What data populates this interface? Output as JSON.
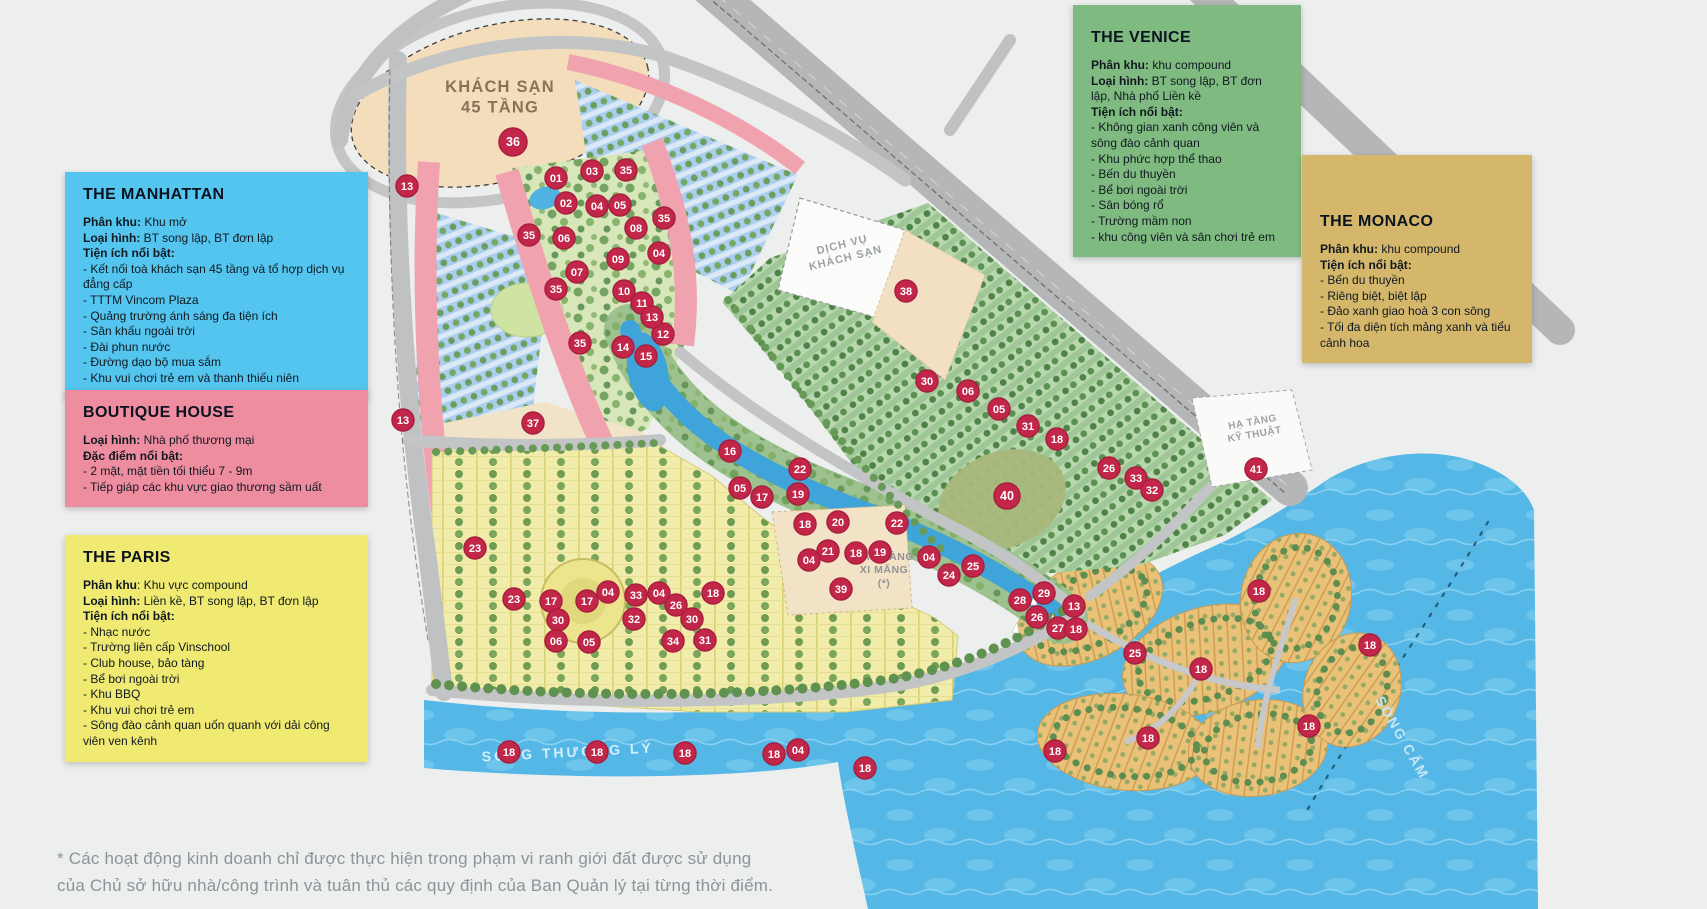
{
  "legends": {
    "manhattan": {
      "title": "THE MANHATTAN",
      "color": "#54c5ee",
      "lines": [
        {
          "b": "Phân khu:",
          "t": " Khu mở"
        },
        {
          "b": "Loại hình:",
          "t": " BT song lập, BT đơn lập"
        },
        {
          "b": "Tiện ích nổi bật:",
          "t": ""
        },
        {
          "b": "",
          "t": "-  Kết nối toà khách sạn 45 tầng và tổ hợp dịch vụ đẳng cấp"
        },
        {
          "b": "",
          "t": "-  TTTM Vincom Plaza"
        },
        {
          "b": "",
          "t": "-  Quảng trường ánh sáng đa tiện ích"
        },
        {
          "b": "",
          "t": "-  Sân khấu ngoài trời"
        },
        {
          "b": "",
          "t": "-  Đài phun nước"
        },
        {
          "b": "",
          "t": "-  Đường dạo bộ mua sắm"
        },
        {
          "b": "",
          "t": "-  Khu vui chơi trẻ em và thanh thiếu niên"
        }
      ]
    },
    "boutique": {
      "title": "BOUTIQUE HOUSE",
      "color": "#ef8da0",
      "lines": [
        {
          "b": "Loại hình:",
          "t": " Nhà phố thương mại"
        },
        {
          "b": "Đặc điểm nổi bật:",
          "t": ""
        },
        {
          "b": "",
          "t": "-  2 mặt, mặt tiền tối thiểu 7 - 9m"
        },
        {
          "b": "",
          "t": "-  Tiếp giáp các khu vực giao thương sầm uất"
        }
      ]
    },
    "paris": {
      "title": "THE PARIS",
      "color": "#f0ea72",
      "lines": [
        {
          "b": "Phân khu",
          "t": ": Khu vực compound"
        },
        {
          "b": "Loại hình:",
          "t": " Liền kề, BT song lập, BT đơn lập"
        },
        {
          "b": "Tiện ích nổi bật:",
          "t": ""
        },
        {
          "b": "",
          "t": "-  Nhạc nước"
        },
        {
          "b": "",
          "t": "-  Trường liên cấp Vinschool"
        },
        {
          "b": "",
          "t": "-  Club house, bảo tàng"
        },
        {
          "b": "",
          "t": "-  Bể bơi ngoài trời"
        },
        {
          "b": "",
          "t": "-  Khu BBQ"
        },
        {
          "b": "",
          "t": "-  Khu vui chơi trẻ em"
        },
        {
          "b": "",
          "t": "-  Sông đào cảnh quan uốn quanh với dải công viên ven kênh"
        }
      ]
    },
    "venice": {
      "title": "THE VENICE",
      "color": "#7fba80",
      "lines": [
        {
          "b": "Phân khu:",
          "t": " khu compound"
        },
        {
          "b": "Loại hình:",
          "t": " BT song lập, BT đơn lập, Nhà phố Liền kề"
        },
        {
          "b": "Tiện ích nổi bật:",
          "t": ""
        },
        {
          "b": "",
          "t": "-  Không gian xanh công viên và sông đào cảnh quan"
        },
        {
          "b": "",
          "t": "-  Khu phức hợp thể thao"
        },
        {
          "b": "",
          "t": "-  Bến du thuyền"
        },
        {
          "b": "",
          "t": "-  Bể bơi ngoài trời"
        },
        {
          "b": "",
          "t": "-  Sân bóng rổ"
        },
        {
          "b": "",
          "t": "-  Trường mầm non"
        },
        {
          "b": "",
          "t": "-  khu công viên và sân chơi trẻ em"
        }
      ]
    },
    "monaco": {
      "title": "THE MONACO",
      "color": "#d4b76b",
      "lines": [
        {
          "b": "Phân khu:",
          "t": " khu compound"
        },
        {
          "b": "Tiện ích nổi bật:",
          "t": ""
        },
        {
          "b": "",
          "t": "-  Bến du thuyền"
        },
        {
          "b": "",
          "t": "-  Riêng biệt, biệt lập"
        },
        {
          "b": "",
          "t": "-  Đảo xanh giao hoà 3 con sông"
        },
        {
          "b": "",
          "t": "-  Tối đa diện tích mảng xanh và tiểu cảnh hoa"
        }
      ]
    }
  },
  "footnote": {
    "line1": "* Các hoạt động kinh doanh chỉ được thực hiện trong phạm vi ranh giới đất được sử dụng",
    "line2": "của Chủ sở hữu nhà/công trình và tuân thủ các quy định của Ban Quản lý tại từng thời điểm."
  },
  "map": {
    "marker_color": "#c2274a",
    "marker_ring_color": "#a81e3e",
    "marker_text_color": "#ffffff",
    "labels": [
      {
        "lines": [
          "KHÁCH SẠN",
          "45 TẦNG"
        ],
        "x": 500,
        "y": 92,
        "size": 16.5,
        "color": "#8b7157",
        "rotate": 0,
        "spacing": 1.2
      },
      {
        "lines": [
          "DỊCH VỤ",
          "KHÁCH SẠN"
        ],
        "x": 843,
        "y": 248,
        "size": 11,
        "color": "#9ba1a5",
        "rotate": -14,
        "spacing": 1
      },
      {
        "lines": [
          "HẠ TẦNG",
          "KỸ THUẬT"
        ],
        "x": 1253,
        "y": 425,
        "size": 10,
        "color": "#9ba1a5",
        "rotate": -10,
        "spacing": 0.5
      },
      {
        "lines": [
          "BẢO TÀNG",
          "XI MĂNG",
          "(*)"
        ],
        "x": 884,
        "y": 560,
        "size": 10.5,
        "color": "#8f9296",
        "rotate": 0,
        "spacing": 0.5
      },
      {
        "lines": [
          "SÔNG THƯỢNG LÝ"
        ],
        "x": 568,
        "y": 757,
        "size": 14,
        "color": "#d5eefb",
        "rotate": -3,
        "spacing": 3
      },
      {
        "lines": [
          "SÔNG CẤM"
        ],
        "x": 1398,
        "y": 740,
        "size": 14,
        "color": "#c4e7f6",
        "rotate": 60,
        "spacing": 2
      }
    ],
    "markers": [
      {
        "n": "36",
        "x": 513,
        "y": 142,
        "r": 14
      },
      {
        "n": "13",
        "x": 407,
        "y": 186
      },
      {
        "n": "01",
        "x": 556,
        "y": 178
      },
      {
        "n": "03",
        "x": 592,
        "y": 171
      },
      {
        "n": "35",
        "x": 626,
        "y": 170
      },
      {
        "n": "02",
        "x": 566,
        "y": 203
      },
      {
        "n": "04",
        "x": 597,
        "y": 206
      },
      {
        "n": "05",
        "x": 620,
        "y": 205
      },
      {
        "n": "08",
        "x": 636,
        "y": 228
      },
      {
        "n": "35",
        "x": 664,
        "y": 218
      },
      {
        "n": "06",
        "x": 564,
        "y": 238
      },
      {
        "n": "35",
        "x": 529,
        "y": 235
      },
      {
        "n": "09",
        "x": 618,
        "y": 259
      },
      {
        "n": "04",
        "x": 659,
        "y": 253
      },
      {
        "n": "07",
        "x": 577,
        "y": 272
      },
      {
        "n": "35",
        "x": 556,
        "y": 289
      },
      {
        "n": "10",
        "x": 624,
        "y": 291
      },
      {
        "n": "11",
        "x": 642,
        "y": 303
      },
      {
        "n": "12",
        "x": 663,
        "y": 334
      },
      {
        "n": "35",
        "x": 580,
        "y": 343
      },
      {
        "n": "13",
        "x": 652,
        "y": 317
      },
      {
        "n": "14",
        "x": 623,
        "y": 347
      },
      {
        "n": "15",
        "x": 646,
        "y": 356
      },
      {
        "n": "13",
        "x": 403,
        "y": 420
      },
      {
        "n": "37",
        "x": 533,
        "y": 423
      },
      {
        "n": "38",
        "x": 906,
        "y": 291
      },
      {
        "n": "16",
        "x": 730,
        "y": 451
      },
      {
        "n": "22",
        "x": 800,
        "y": 469
      },
      {
        "n": "05",
        "x": 740,
        "y": 488
      },
      {
        "n": "17",
        "x": 762,
        "y": 497
      },
      {
        "n": "19",
        "x": 798,
        "y": 494
      },
      {
        "n": "18",
        "x": 805,
        "y": 524
      },
      {
        "n": "20",
        "x": 838,
        "y": 522
      },
      {
        "n": "22",
        "x": 897,
        "y": 523
      },
      {
        "n": "21",
        "x": 828,
        "y": 551
      },
      {
        "n": "04",
        "x": 809,
        "y": 560
      },
      {
        "n": "18",
        "x": 856,
        "y": 553
      },
      {
        "n": "19",
        "x": 880,
        "y": 552
      },
      {
        "n": "04",
        "x": 929,
        "y": 557
      },
      {
        "n": "24",
        "x": 949,
        "y": 575
      },
      {
        "n": "25",
        "x": 973,
        "y": 566
      },
      {
        "n": "39",
        "x": 841,
        "y": 589
      },
      {
        "n": "40",
        "x": 1007,
        "y": 496,
        "r": 13
      },
      {
        "n": "30",
        "x": 927,
        "y": 381
      },
      {
        "n": "06",
        "x": 968,
        "y": 391
      },
      {
        "n": "05",
        "x": 999,
        "y": 409
      },
      {
        "n": "31",
        "x": 1028,
        "y": 426
      },
      {
        "n": "18",
        "x": 1057,
        "y": 439
      },
      {
        "n": "26",
        "x": 1109,
        "y": 468
      },
      {
        "n": "33",
        "x": 1136,
        "y": 478
      },
      {
        "n": "32",
        "x": 1152,
        "y": 490
      },
      {
        "n": "41",
        "x": 1256,
        "y": 469
      },
      {
        "n": "23",
        "x": 475,
        "y": 548
      },
      {
        "n": "23",
        "x": 514,
        "y": 599
      },
      {
        "n": "17",
        "x": 551,
        "y": 601
      },
      {
        "n": "30",
        "x": 558,
        "y": 620
      },
      {
        "n": "17",
        "x": 587,
        "y": 601
      },
      {
        "n": "04",
        "x": 608,
        "y": 592
      },
      {
        "n": "33",
        "x": 636,
        "y": 595
      },
      {
        "n": "32",
        "x": 634,
        "y": 619
      },
      {
        "n": "04",
        "x": 659,
        "y": 593
      },
      {
        "n": "26",
        "x": 676,
        "y": 605
      },
      {
        "n": "30",
        "x": 692,
        "y": 619
      },
      {
        "n": "18",
        "x": 713,
        "y": 593
      },
      {
        "n": "06",
        "x": 556,
        "y": 641
      },
      {
        "n": "05",
        "x": 589,
        "y": 642
      },
      {
        "n": "34",
        "x": 673,
        "y": 641
      },
      {
        "n": "31",
        "x": 705,
        "y": 640
      },
      {
        "n": "28",
        "x": 1020,
        "y": 600
      },
      {
        "n": "29",
        "x": 1044,
        "y": 593
      },
      {
        "n": "26",
        "x": 1037,
        "y": 617
      },
      {
        "n": "27",
        "x": 1058,
        "y": 628
      },
      {
        "n": "13",
        "x": 1074,
        "y": 606
      },
      {
        "n": "25",
        "x": 1135,
        "y": 653
      },
      {
        "n": "18",
        "x": 509,
        "y": 752
      },
      {
        "n": "18",
        "x": 597,
        "y": 752
      },
      {
        "n": "18",
        "x": 685,
        "y": 753
      },
      {
        "n": "18",
        "x": 774,
        "y": 754
      },
      {
        "n": "04",
        "x": 798,
        "y": 750
      },
      {
        "n": "18",
        "x": 865,
        "y": 768
      },
      {
        "n": "18",
        "x": 1076,
        "y": 629
      },
      {
        "n": "18",
        "x": 1259,
        "y": 591
      },
      {
        "n": "18",
        "x": 1201,
        "y": 669
      },
      {
        "n": "18",
        "x": 1309,
        "y": 726
      },
      {
        "n": "18",
        "x": 1370,
        "y": 645
      },
      {
        "n": "18",
        "x": 1055,
        "y": 751
      },
      {
        "n": "18",
        "x": 1148,
        "y": 738
      }
    ]
  }
}
